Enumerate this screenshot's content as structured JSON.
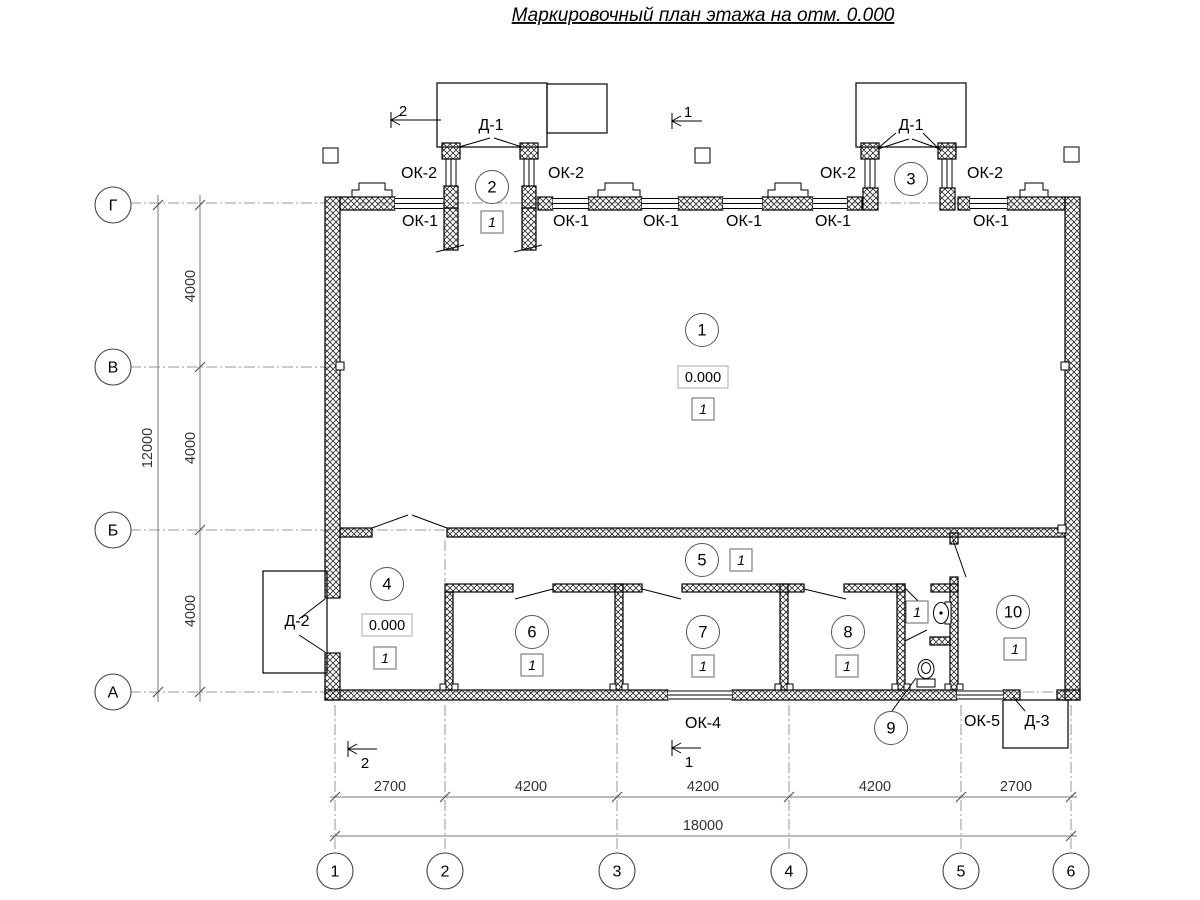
{
  "title": "Маркировочный план этажа на отм. 0.000",
  "axes": {
    "rows": [
      "Г",
      "В",
      "Б",
      "А"
    ],
    "cols": [
      "1",
      "2",
      "3",
      "4",
      "5",
      "6"
    ]
  },
  "dims": {
    "v_segments": [
      "4000",
      "4000",
      "4000"
    ],
    "v_total": "12000",
    "h_segments": [
      "2700",
      "4200",
      "4200",
      "4200",
      "2700"
    ],
    "h_total": "18000"
  },
  "sections": {
    "s1": "1",
    "s2": "2"
  },
  "rooms": {
    "r1": "1",
    "r2": "2",
    "r3": "3",
    "r4": "4",
    "r5": "5",
    "r6": "6",
    "r7": "7",
    "r8": "8",
    "r9": "9",
    "r10": "10"
  },
  "marks": {
    "elevation": "0.000",
    "floor_type": "1"
  },
  "openings": {
    "ok1": "ОК-1",
    "ok2": "ОК-2",
    "ok4": "ОК-4",
    "ok5": "ОК-5",
    "d1": "Д-1",
    "d2": "Д-2",
    "d3": "Д-3"
  }
}
